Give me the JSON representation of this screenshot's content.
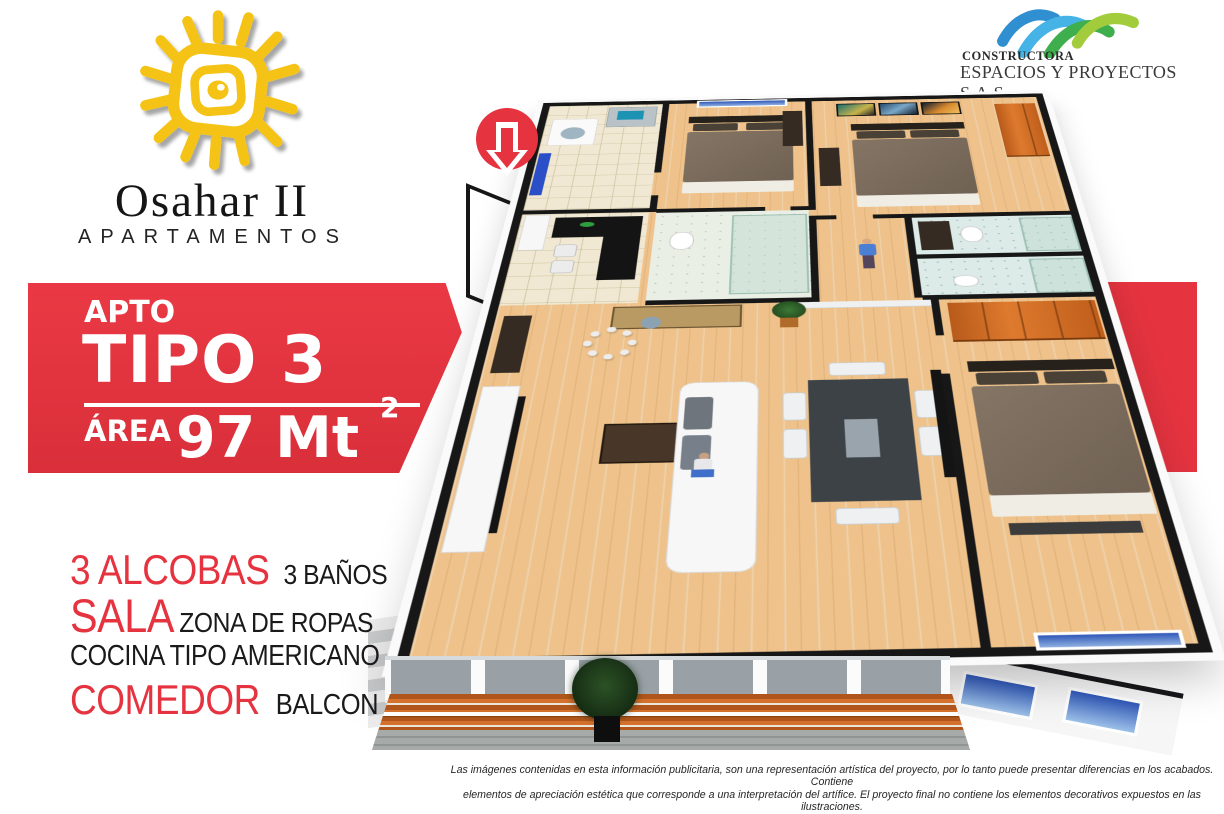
{
  "brand": {
    "name": "Osahar II",
    "subtitle": "APARTAMENTOS"
  },
  "builder": {
    "line1": "CONSTRUCTORA",
    "line2": "ESPACIOS Y PROYECTOS S.A.S."
  },
  "banner": {
    "apto": "APTO",
    "type": "TIPO 3",
    "area_label": "ÁREA",
    "area_value": "97 Mt",
    "area_sup": "2"
  },
  "features": {
    "rows": [
      {
        "red": "3 ALCOBAS",
        "black": "3 BAÑOS"
      },
      {
        "red": "SALA",
        "black": "ZONA DE ROPAS"
      },
      {
        "red": "",
        "black": "COCINA TIPO AMERICANO"
      },
      {
        "red": "COMEDOR",
        "black": "BALCON"
      }
    ]
  },
  "disclaimer": {
    "line1": "Las imágenes contenidas en esta información publicitaria, son una representación artística del proyecto, por lo tanto puede presentar diferencias en los acabados. Contiene",
    "line2": "elementos de apreciación estética que corresponde a una interpretación del artífice. El proyecto final no contiene los elementos decorativos expuestos en las ilustraciones."
  },
  "colors": {
    "accent_red": "#e5333f",
    "brand_yellow": "#f5c316",
    "wood_floor": "#eec28a",
    "closet_orange": "#cd6522",
    "builder_blue": "#3fa8dd",
    "builder_green": "#55b54a"
  },
  "icons": {
    "brand_mark": "yellow-sun-spiral-icon",
    "builder_mark": "blue-green-arcs-icon",
    "entrance_arrow": "red-circle-down-arrow-icon"
  }
}
